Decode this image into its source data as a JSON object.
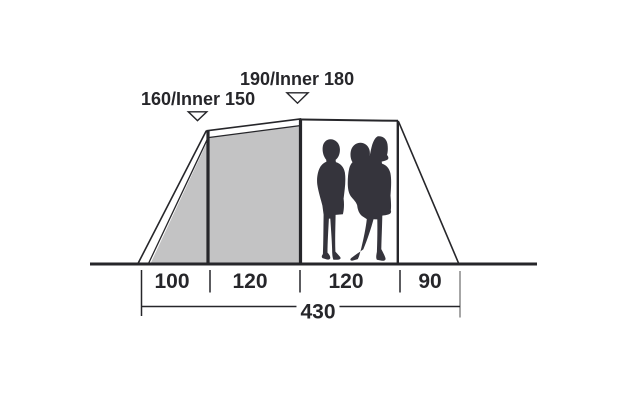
{
  "diagram": {
    "title": "Tent side profile with dimensions",
    "height_labels": [
      {
        "label": "160/Inner 150"
      },
      {
        "label": "190/Inner 180"
      }
    ],
    "width_segments": [
      {
        "label": "100"
      },
      {
        "label": "120"
      },
      {
        "label": "120"
      },
      {
        "label": "90"
      }
    ],
    "total_width": {
      "label": "430"
    },
    "icons": {
      "pointer_left": "arrow-down-icon",
      "pointer_right": "arrow-down-icon",
      "people": "family-silhouette-icon"
    },
    "colors": {
      "line": "#26262a",
      "panel_fill": "#c3c3c4",
      "silhouette": "#35343c",
      "gray_tick": "#a6a6a6",
      "background": "#ffffff"
    }
  }
}
